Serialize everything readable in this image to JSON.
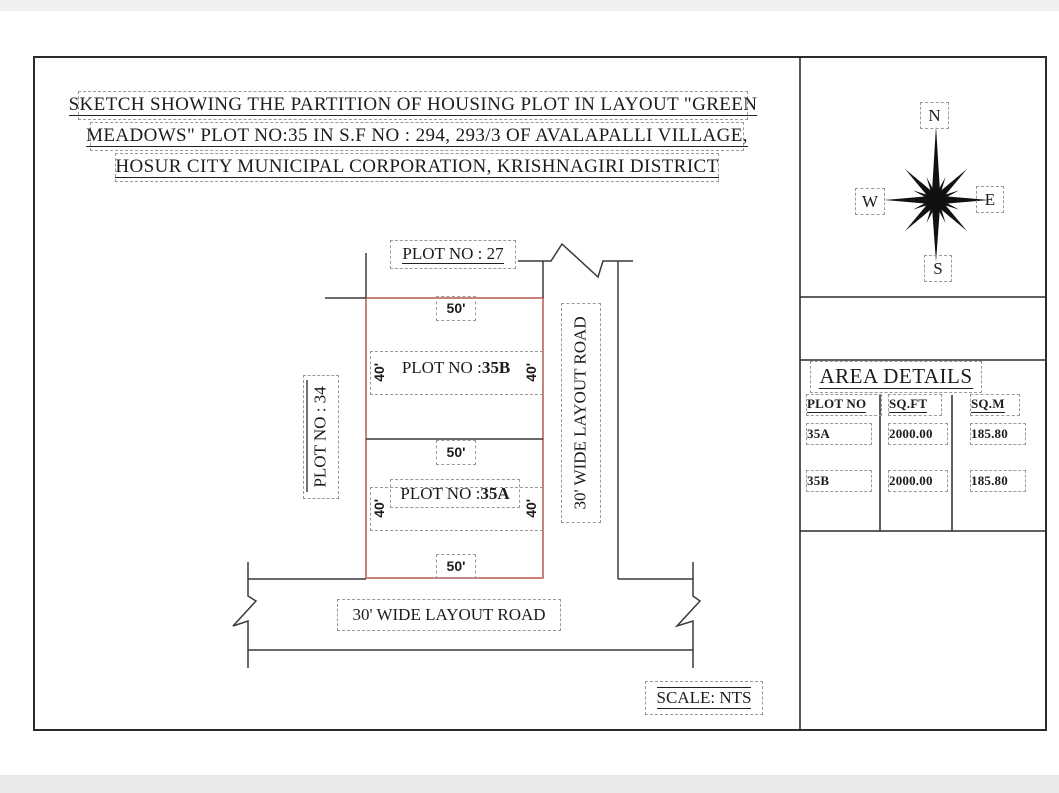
{
  "title": {
    "line1": "SKETCH SHOWING THE PARTITION OF HOUSING PLOT IN LAYOUT \"GREEN",
    "line2": "MEADOWS\" PLOT NO:35 IN S.F NO : 294, 293/3 OF AVALAPALLI VILLAGE,",
    "line3": "HOSUR CITY MUNICIPAL CORPORATION, KRISHNAGIRI DISTRICT"
  },
  "compass": {
    "n": "N",
    "e": "E",
    "s": "S",
    "w": "W"
  },
  "drawing": {
    "plot27_label": "PLOT NO : 27",
    "plot34_label": "PLOT NO : 34",
    "plot_prefix": "PLOT NO : ",
    "plot35b_id": "35B",
    "plot35a_id": "35A",
    "road_vertical_label": "30' WIDE LAYOUT ROAD",
    "road_bottom_label": "30' WIDE LAYOUT ROAD",
    "dim_50": "50'",
    "dim_40": "40'",
    "scale_label": "SCALE: NTS"
  },
  "area_details": {
    "title": "AREA DETAILS",
    "columns": [
      "PLOT NO",
      "SQ.FT",
      "SQ.M"
    ],
    "rows": [
      {
        "plot_no": "35A",
        "sq_ft": "2000.00",
        "sq_m": "185.80"
      },
      {
        "plot_no": "35B",
        "sq_ft": "2000.00",
        "sq_m": "185.80"
      }
    ]
  },
  "colors": {
    "plot_outline": "#c36a63",
    "line": "#333333",
    "dash": "#9a9a9a"
  }
}
